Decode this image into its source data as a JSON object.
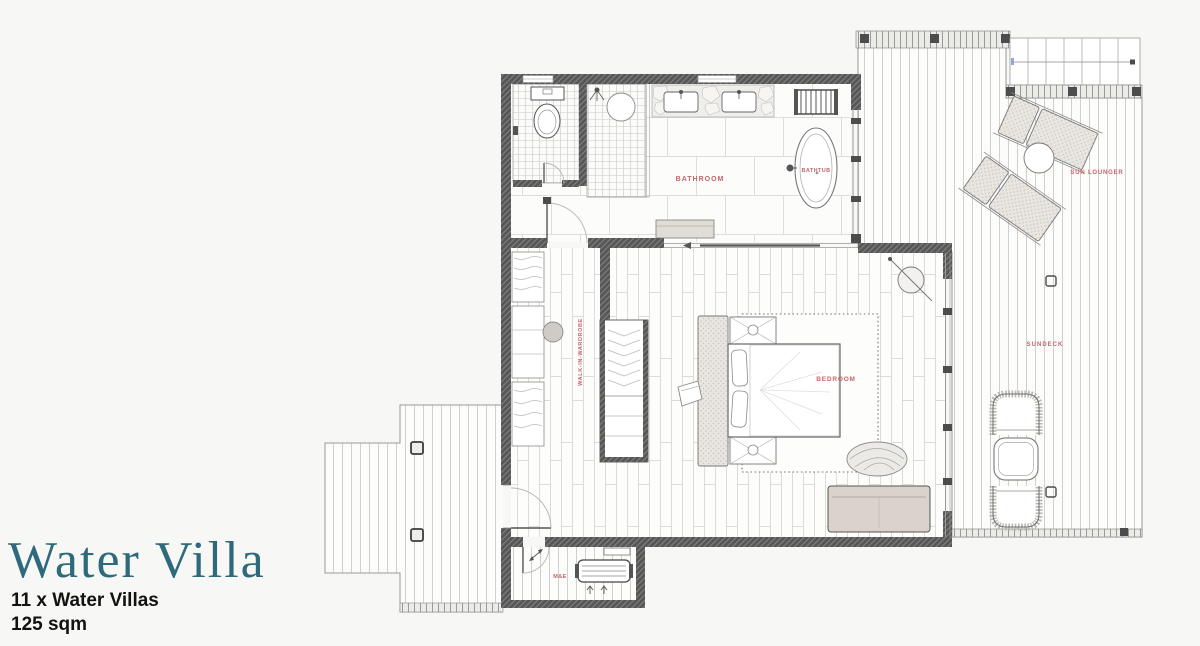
{
  "title": {
    "name": "Water Villa",
    "count_line": "11 x Water Villas",
    "area_line": "125 sqm"
  },
  "plan": {
    "rooms": {
      "bathroom": "BATHROOM",
      "bathtub": "BATHTUB",
      "bedroom": "BEDROOM",
      "walk_in_wardrobe": "WALK-IN-WARDROBE",
      "sundeck": "SUNDECK",
      "sun_lounger": "SUN LOUNGER",
      "mech_elec": "M&E"
    }
  },
  "colors": {
    "accent_teal": "#2E6A7B",
    "label_red": "#C4666B",
    "wall_dark": "#565656",
    "background": "#F7F8F6",
    "text_dark": "#121212"
  }
}
